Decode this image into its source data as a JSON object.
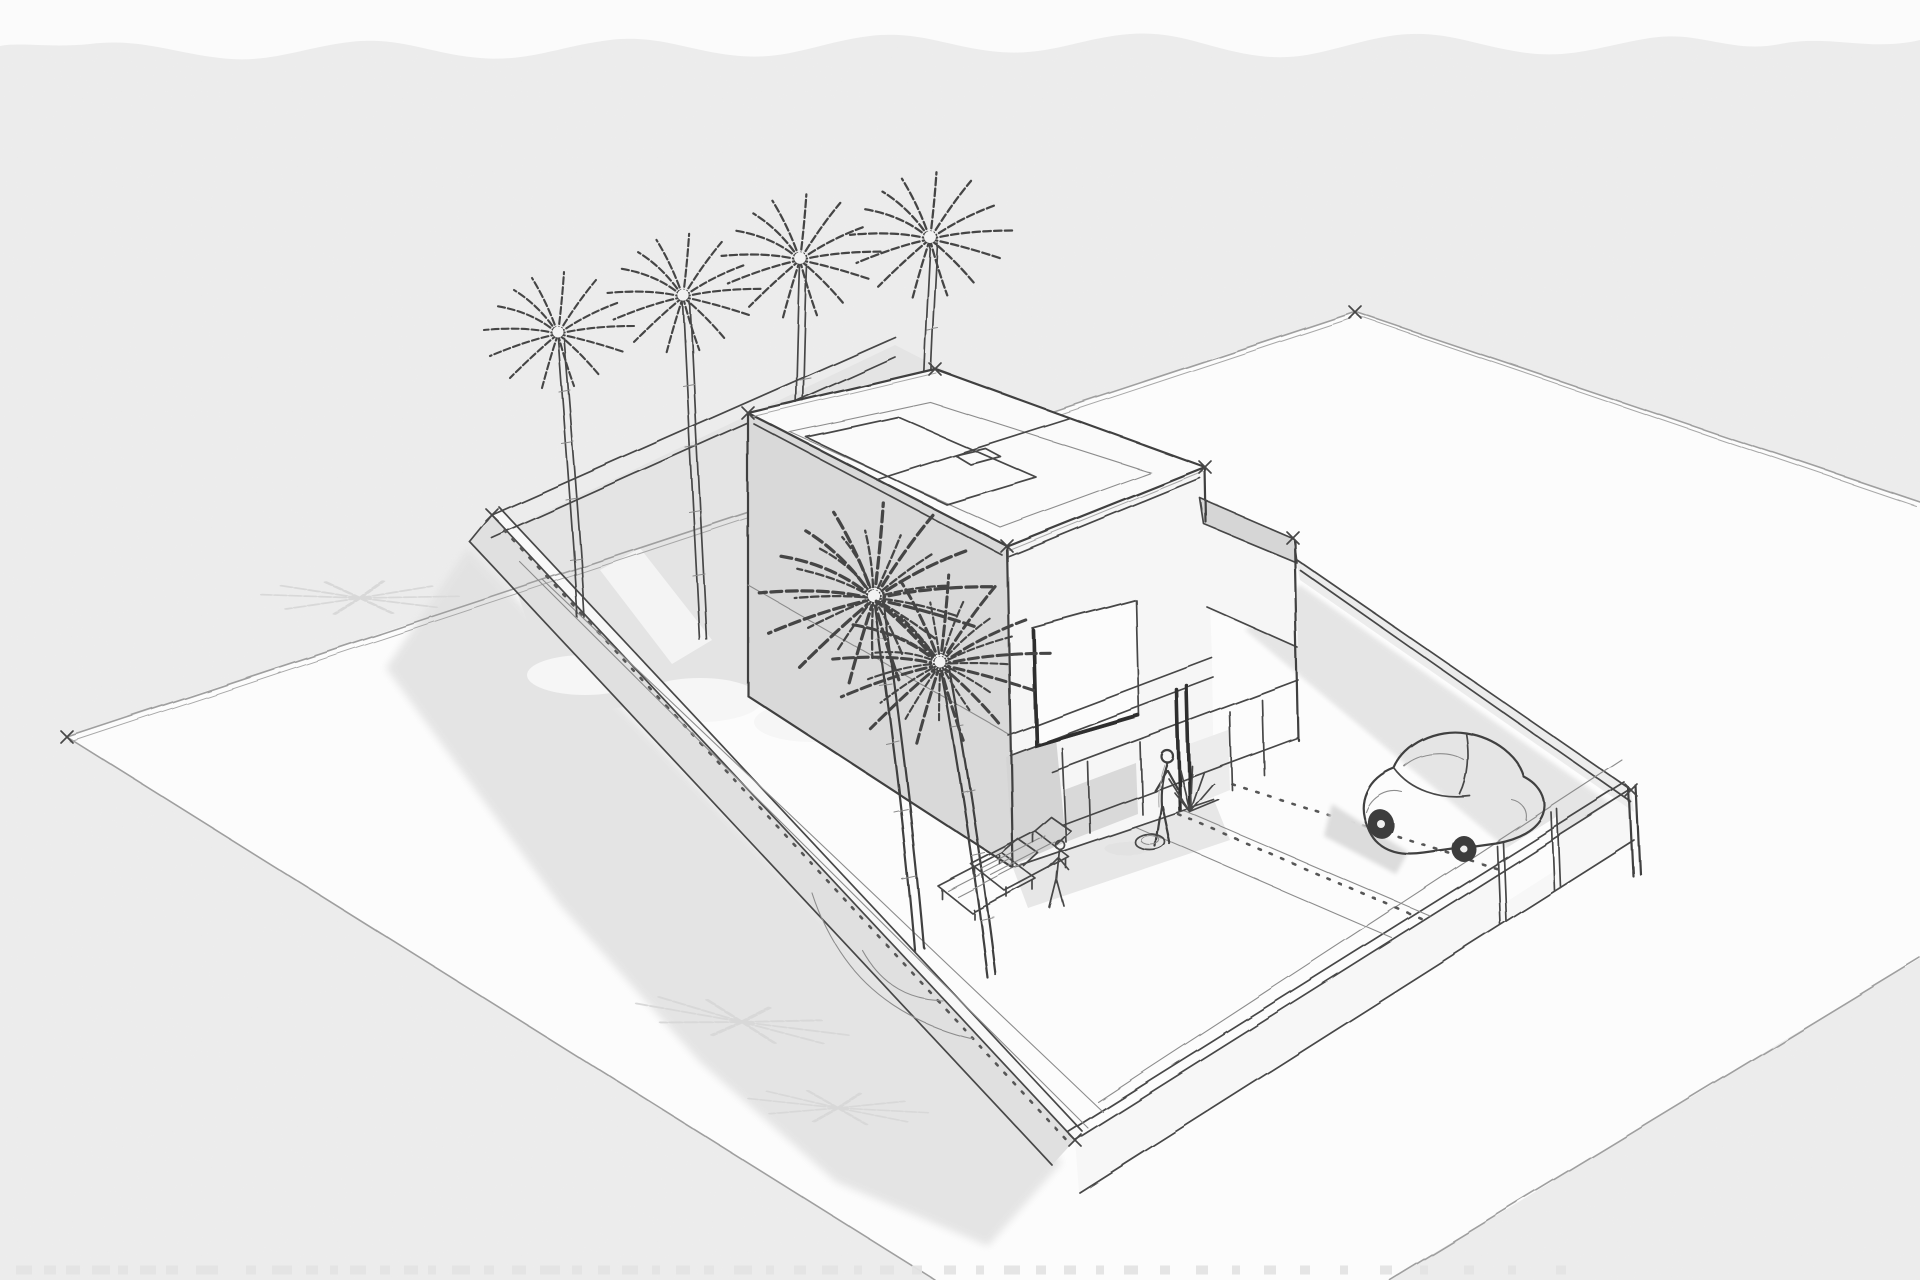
{
  "document": {
    "kind": "architectural concept sketch",
    "view": "aerial three-quarter perspective",
    "style": "hand-drawn pencil and ink line sketch on textured watercolor paper",
    "description": "Freehand perspective sketch of a modern two-story flat-roof house on a walled lot with palm trees, sun loungers, two figures, a compact rounded car on the driveway and soft cast shadows on the surrounding street plane."
  },
  "colors": {
    "paper": "#ededed",
    "paper_top_band": "#fbfbfb",
    "street": "#fcfcfc",
    "ink": "#474747",
    "ink_light": "#8c8c8c",
    "shadow_soft": "#e2e2e2",
    "shadow_palm": "#d8d8d8",
    "garden_gray": "#e4e4e4",
    "house_shaded_face": "#d9d9d9",
    "house_lit_face": "#f6f6f6",
    "roof_white": "#fafafa",
    "wing_roof_gray": "#d6d6d6",
    "glass_dark": "#d9d9d9",
    "recess_dark": "#d4d4d4",
    "wheel_dark": "#3d3d3d"
  },
  "scene": {
    "ground": {
      "label": "street and open ground plane with corner tick marks"
    },
    "plot": {
      "label": "walled rectangular plot",
      "walls": [
        "back-left garden wall",
        "front-left boundary wall",
        "front-right boundary wall with gate posts",
        "back-right boundary wall"
      ]
    },
    "house": {
      "label": "two-story flat-roof modern house",
      "features": [
        "roof parapet",
        "rooflight panels",
        "shaded side facade",
        "large upper-floor window",
        "recessed full-height glass doors",
        "single-story side wing"
      ]
    },
    "vegetation": {
      "back_palm_count": 4,
      "front_palm_count": 2,
      "accent_plant": "spiky shrub at entrance",
      "planting_beds": 3
    },
    "figures": {
      "person_at_entrance": 1,
      "small_figure_in_courtyard": 1
    },
    "furniture": {
      "sun_loungers": 2,
      "planter_pot": 1
    },
    "vehicle": {
      "label": "compact rounded car on driveway",
      "count": 1
    },
    "shadows": [
      "house and wall shadow on street",
      "palm frond shadows",
      "car shadow",
      "wall shadow band on driveway",
      "person shadow"
    ],
    "paper_marks": {
      "torn_top_edge": true,
      "faint_bottom_edge_marks": true
    }
  }
}
